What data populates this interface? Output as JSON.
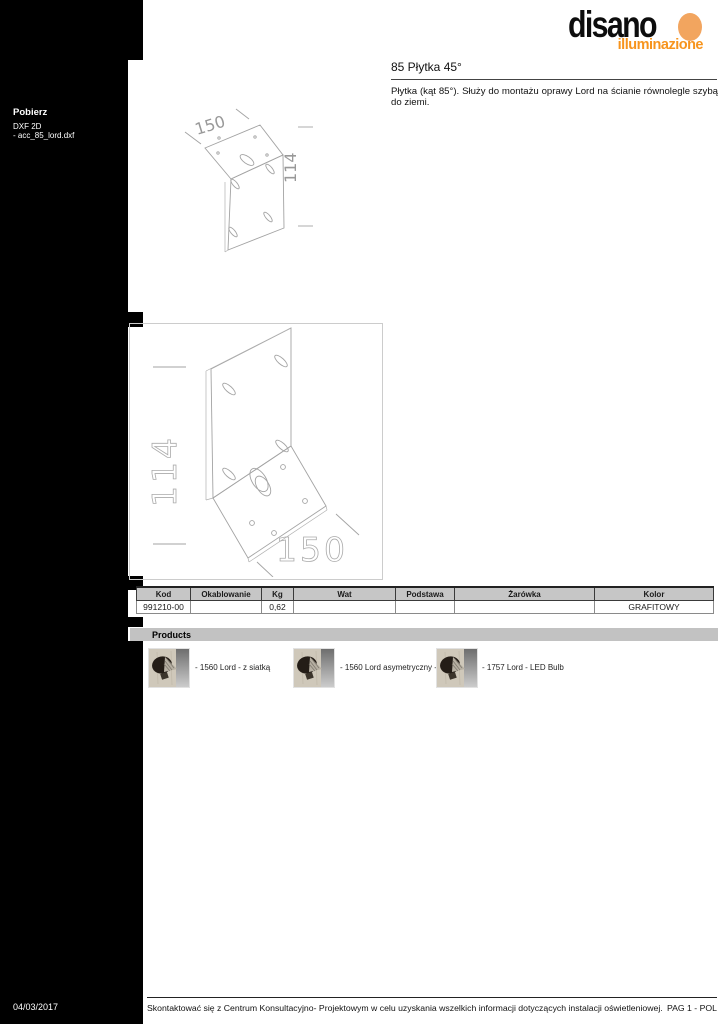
{
  "sidebar": {
    "download_heading": "Pobierz",
    "download_format": "DXF 2D",
    "download_file": "- acc_85_lord.dxf",
    "date": "04/03/2017"
  },
  "logo": {
    "brand": "disano",
    "sub": "illuminazione",
    "orange": "#f7941d",
    "ellipse_color": "#f2a55f"
  },
  "header": {
    "title": "85 Płytka 45°",
    "description": "Płytka (kąt 85°). Służy do montażu oprawy Lord na ścianie równolegle szybą do ziemi."
  },
  "drawings": {
    "small": {
      "width_label": "150",
      "height_label": "114"
    },
    "large": {
      "width_label": "150",
      "height_label": "114"
    }
  },
  "table": {
    "headers": [
      "Kod",
      "Okablowanie",
      "Kg",
      "Wat",
      "Podstawa",
      "Żarówka",
      "Kolor"
    ],
    "rows": [
      [
        "991210-00",
        "",
        "0,62",
        "",
        "",
        "",
        "GRAFITOWY"
      ]
    ]
  },
  "products": {
    "heading": "Products",
    "items": [
      {
        "label": "- 1560 Lord - z siatką"
      },
      {
        "label": "- 1560 Lord asymetryczny - z"
      },
      {
        "label": "- 1757 Lord - LED Bulb"
      }
    ]
  },
  "footer": {
    "note": "Skontaktować się z Centrum Konsultacyjno- Projektowym w celu uzyskania wszelkich informacji dotyczących instalacji oświetleniowej.",
    "page_ref": "PAG  1 - POL"
  }
}
